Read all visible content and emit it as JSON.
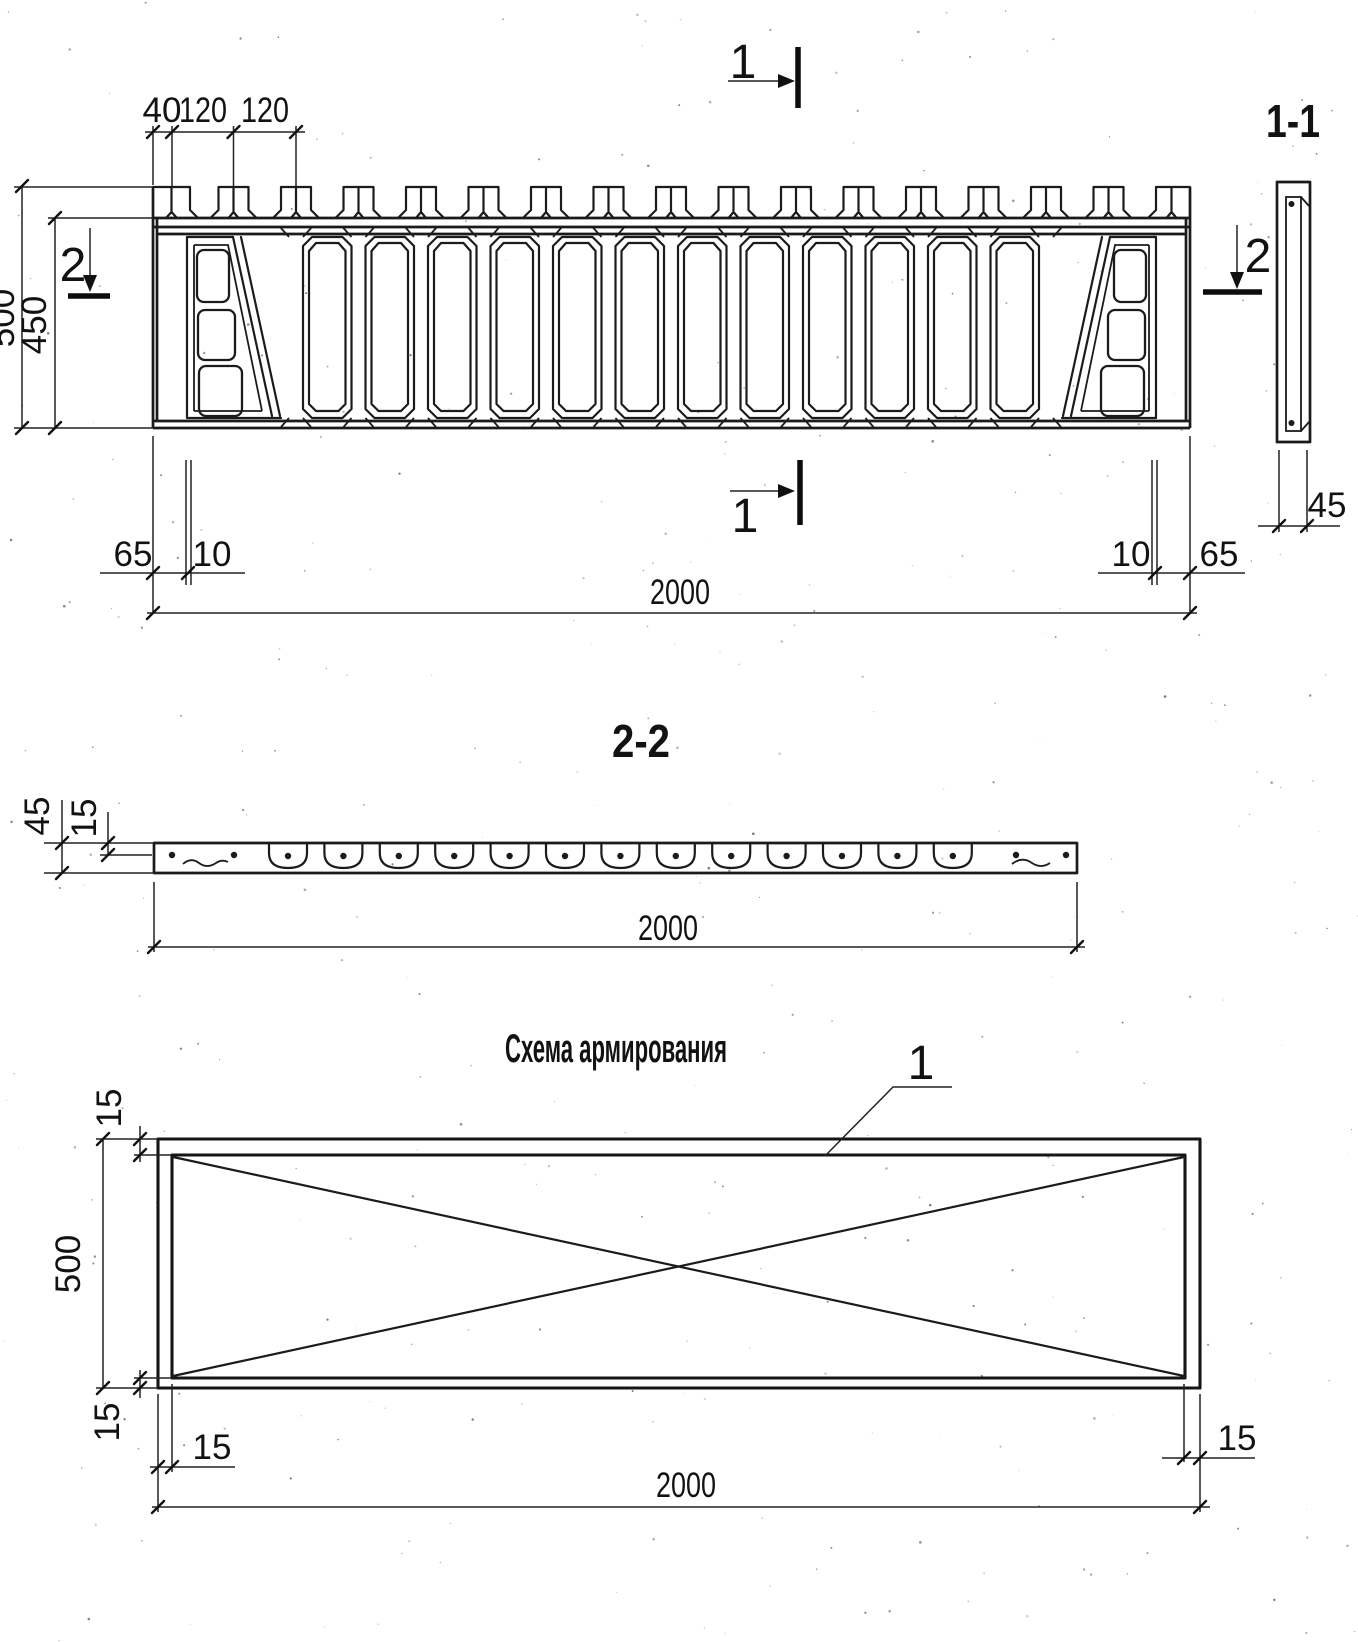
{
  "page": {
    "background": "#ffffff",
    "ink": "#1b1b1b"
  },
  "elevation": {
    "cut_marks": {
      "top": "1",
      "bottom": "1",
      "left": "2",
      "right": "2"
    },
    "dims": {
      "edge_to_first_tooth": "40",
      "tooth_pitch_a": "120",
      "tooth_pitch_b": "120",
      "overall_height": "500",
      "body_height": "450",
      "left_margin": "65",
      "left_groove": "10",
      "right_groove": "10",
      "right_margin": "65",
      "length": "2000"
    }
  },
  "section_1_1": {
    "title": "1-1",
    "dims": {
      "thickness": "45"
    }
  },
  "section_2_2": {
    "title": "2-2",
    "dims": {
      "thickness": "45",
      "rebar_cover": "15",
      "length": "2000"
    }
  },
  "reinforcement_scheme": {
    "title": "Схема армирования",
    "rebar_callout": "1",
    "dims": {
      "top_cover": "15",
      "height": "500",
      "bottom_cover": "15",
      "left_cover": "15",
      "right_cover": "15",
      "length": "2000"
    }
  }
}
